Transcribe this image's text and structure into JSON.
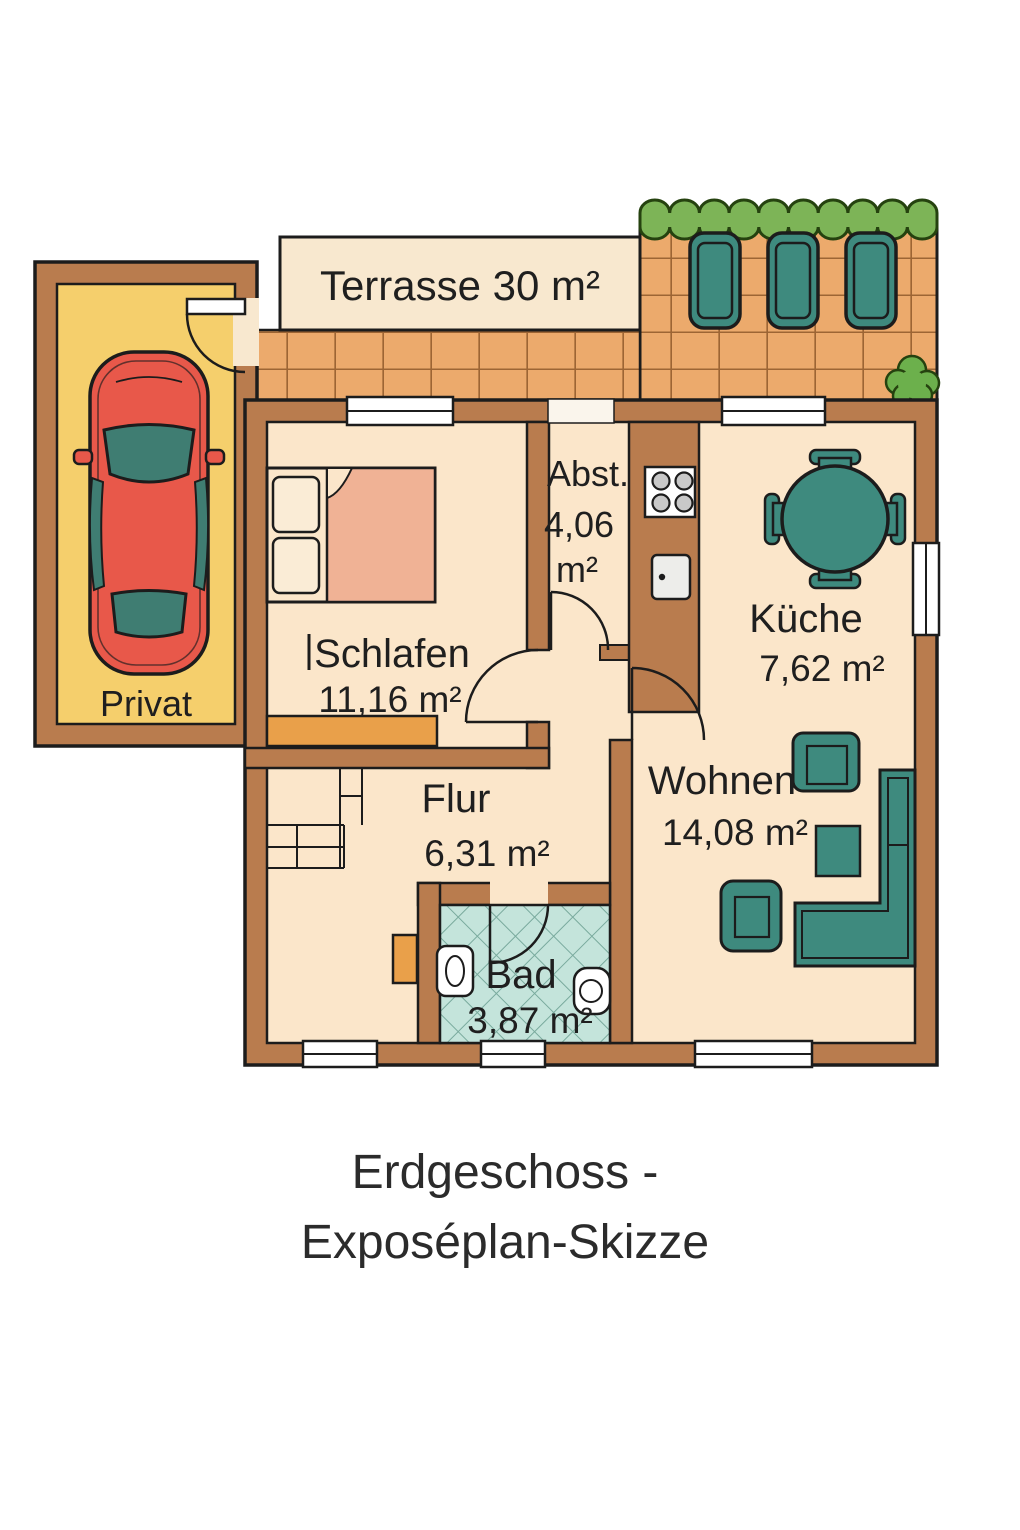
{
  "title": {
    "line1": "Erdgeschoss -",
    "line2": "Exposéplan-Skizze"
  },
  "rooms": {
    "terrasse": {
      "label": "Terrasse 30 m²"
    },
    "garage": {
      "label": "Privat"
    },
    "schlafen": {
      "name": "Schlafen",
      "area": "11,16 m²"
    },
    "abstellraum": {
      "name": "Abst.",
      "area_value": "4,06",
      "area_unit": "m²"
    },
    "kueche": {
      "name": "Küche",
      "area": "7,62 m²"
    },
    "wohnen": {
      "name": "Wohnen",
      "area": "14,08 m²"
    },
    "flur": {
      "name": "Flur",
      "area": "6,31 m²"
    },
    "bad": {
      "name": "Bad",
      "area": "3,87 m²"
    }
  },
  "colors": {
    "wall": "#b97c4e",
    "room_floor": "#fbe6ca",
    "terrace_tile": "#ecaa6c",
    "terrace_label_band": "#f8e8cf",
    "garage_floor": "#f5cf6c",
    "hedge_green": "#7db457",
    "bush_green": "#6cb04c",
    "furniture_teal": "#3e8a7e",
    "car_red": "#e8584a",
    "car_window": "#3f7d72",
    "bath_tile": "#c4e4db",
    "bed_blanket": "#f0b295",
    "pillow": "#faecd6",
    "sideboard_orange": "#e9a04a",
    "appliance_white": "#ededea",
    "outline": "#1c1c1c",
    "text": "#1f1f1f"
  }
}
